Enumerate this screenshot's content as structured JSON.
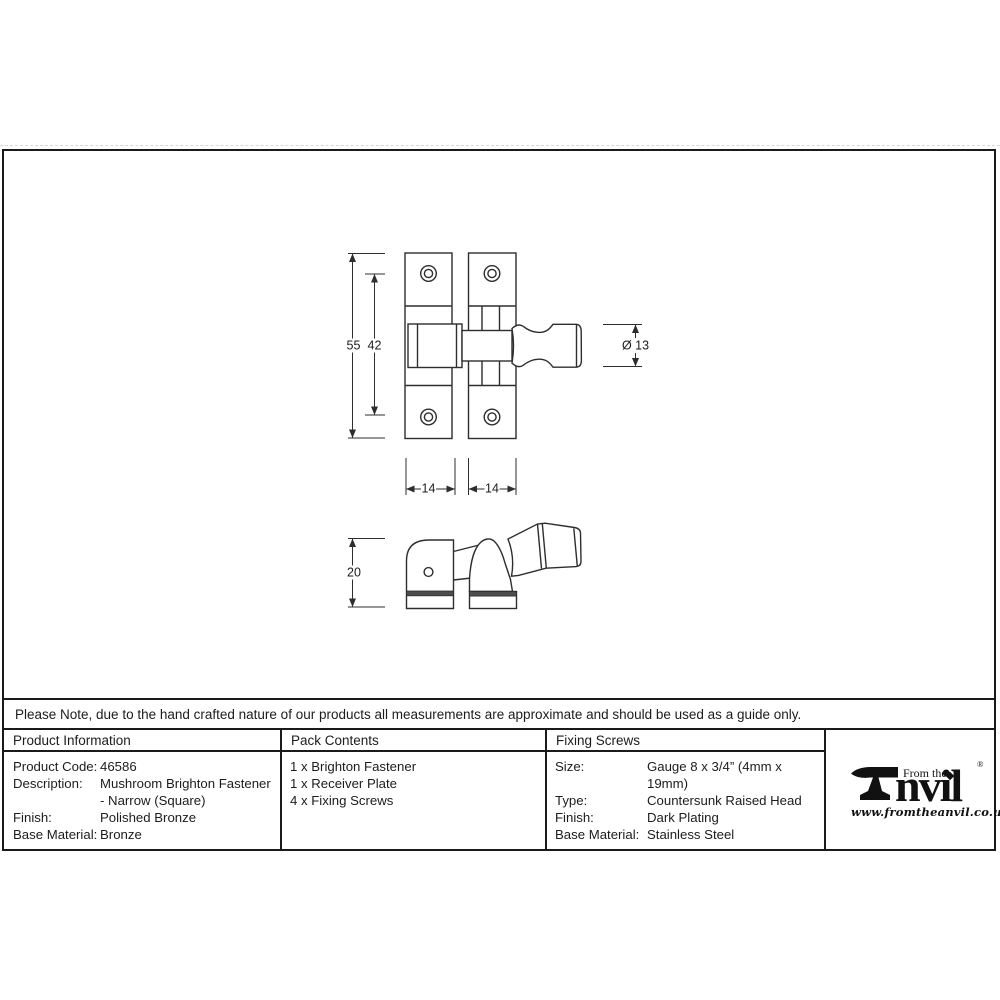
{
  "note": "Please Note, due to the hand crafted nature of our products all measurements are approximate and should be used as a guide only.",
  "drawing": {
    "dimensions": {
      "overall_height": "55",
      "hole_spacing": "42",
      "knob_diameter": "Ø 13",
      "left_plate_width": "14",
      "right_plate_width": "14",
      "side_height": "20"
    }
  },
  "table": {
    "product_information": {
      "header": "Product Information",
      "rows": [
        {
          "label": "Product Code:",
          "value": "46586"
        },
        {
          "label": "Description:",
          "value": "Mushroom Brighton Fastener"
        },
        {
          "label": "",
          "value": "- Narrow (Square)"
        },
        {
          "label": "Finish:",
          "value": "Polished Bronze"
        },
        {
          "label": "Base Material:",
          "value": "Bronze"
        }
      ]
    },
    "pack_contents": {
      "header": "Pack Contents",
      "items": [
        "1 x Brighton Fastener",
        "1 x Receiver Plate",
        "4 x Fixing Screws"
      ]
    },
    "fixing_screws": {
      "header": "Fixing Screws",
      "rows": [
        {
          "label": "Size:",
          "value": "Gauge 8 x 3/4” (4mm x 19mm)"
        },
        {
          "label": "Type:",
          "value": "Countersunk Raised Head"
        },
        {
          "label": "Finish:",
          "value": "Dark Plating"
        },
        {
          "label": "Base Material:",
          "value": "Stainless Steel"
        }
      ]
    }
  },
  "logo": {
    "icon": "anvil-icon",
    "tagline": "From the",
    "name_rest": "nvil",
    "registered": "®",
    "url": "www.fromtheanvil.co.uk"
  }
}
